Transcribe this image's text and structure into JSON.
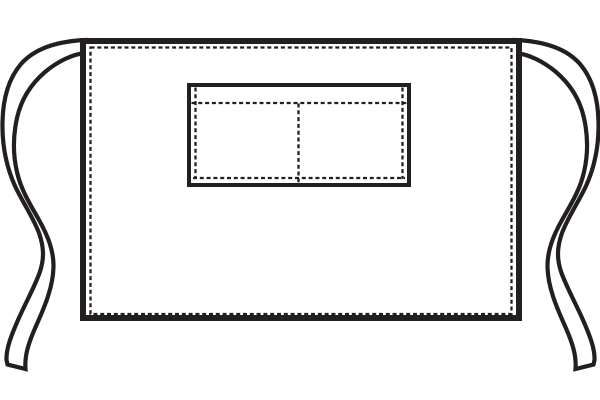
{
  "image": {
    "title": "Waist apron with divided front pocket — outline drawing",
    "style": "black-and-white vector line art",
    "background_color": "#ffffff"
  },
  "colors": {
    "line": "#231f20",
    "fabric_fill": "#ffffff"
  },
  "apron": {
    "body": {
      "label": "apron body panel",
      "stitching": "dashed hem stitch just inside all four edges"
    },
    "pocket": {
      "label": "front patch pocket",
      "compartments": 2,
      "stitching": "dashed fold-over hem at top, dashed stitch lines at sides and bottom, dashed center divider"
    },
    "ties": {
      "left": "left waist tie ribbon",
      "right": "right waist tie ribbon"
    }
  }
}
